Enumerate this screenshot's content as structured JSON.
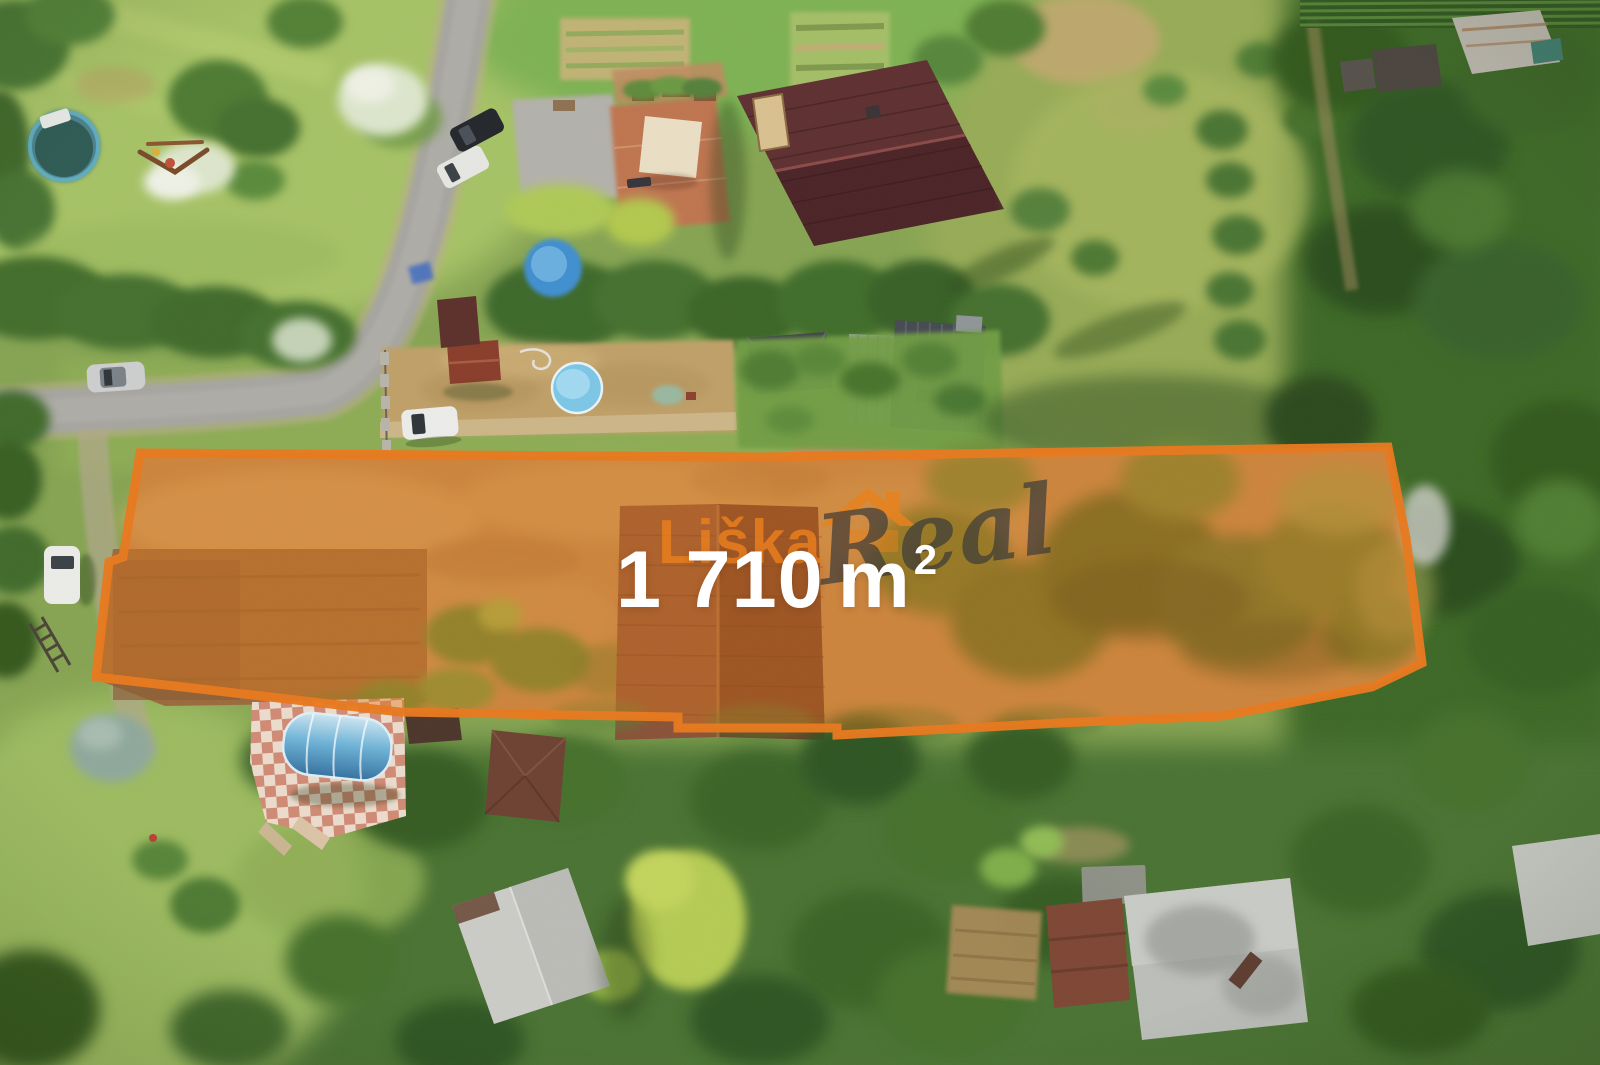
{
  "image": {
    "kind": "aerial-drone-photo-with-plot-highlight",
    "width_px": 1600,
    "height_px": 1065
  },
  "plot": {
    "area_value": "1 710",
    "area_unit": "m",
    "area_superscript": "2",
    "label_color": "#ffffff",
    "outline_color": "#e8791d",
    "fill_color": "#e0761b",
    "polygon_points": "140,453 760,457 1388,447 1406,538 1422,663 1372,687 1223,716 1060,723 837,735 837,728 678,728 678,717 400,712 96,677 109,562 123,557"
  },
  "watermark": {
    "brand_word_1": "Liška",
    "brand_word_2": "Real",
    "icon": "house-roof-icon",
    "word1_color": "#e8821e",
    "word2_color": "#3a3a3a"
  },
  "scene": {
    "features": [
      "asphalt-road",
      "round-above-ground-pool",
      "playground",
      "flowering-bushes",
      "house-dark-maroon-roof",
      "terracotta-patio",
      "shade-canopy",
      "concrete-driveway",
      "vegetable-garden",
      "houses-grey-roofs",
      "courtyard-with-round-pool",
      "parked-cars",
      "dirt-building-plot",
      "plowed-parcel",
      "gable-roof-inside-plot",
      "dense-forest-right",
      "checkered-patio-with-pool-dome",
      "bottom-left-house",
      "bottom-right-houses",
      "meadow-orchard"
    ],
    "palette": {
      "grass": "#86a452",
      "meadow_light": "#a6c265",
      "forest_dark": "#3e6828",
      "dirt_plot": "#bf8e55",
      "road": "#a7a5a0",
      "roof_maroon": "#552a2c",
      "roof_grey": "#454a50",
      "pool_blue": "#7cc6e6"
    }
  }
}
